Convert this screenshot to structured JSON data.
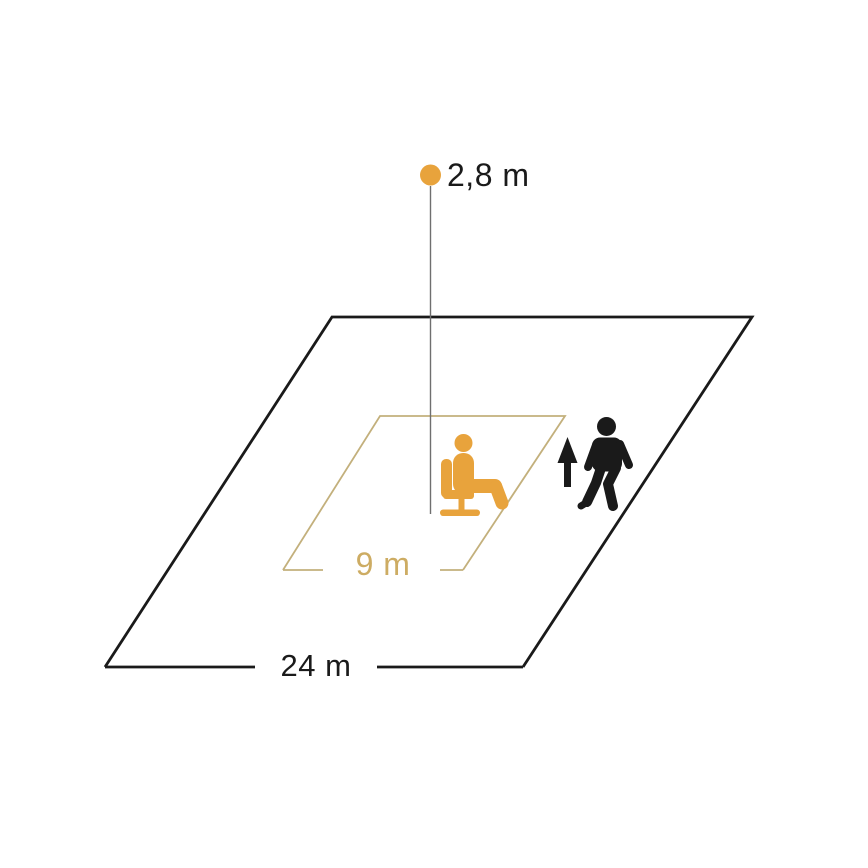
{
  "diagram": {
    "labels": {
      "mounting_height": "2,8 m",
      "presence_range": "9 m",
      "motion_range": "24 m"
    },
    "icons": [
      "sensor-dot",
      "seated-person-icon",
      "up-arrow-icon",
      "walking-person-icon"
    ]
  },
  "colors": {
    "orange": "#E8A33C",
    "gold_line": "#C3B07C",
    "gold_text": "#CDAC63",
    "black": "#1A1A1A",
    "gray_line": "#6F6F6F",
    "background": "#FFFFFF"
  }
}
